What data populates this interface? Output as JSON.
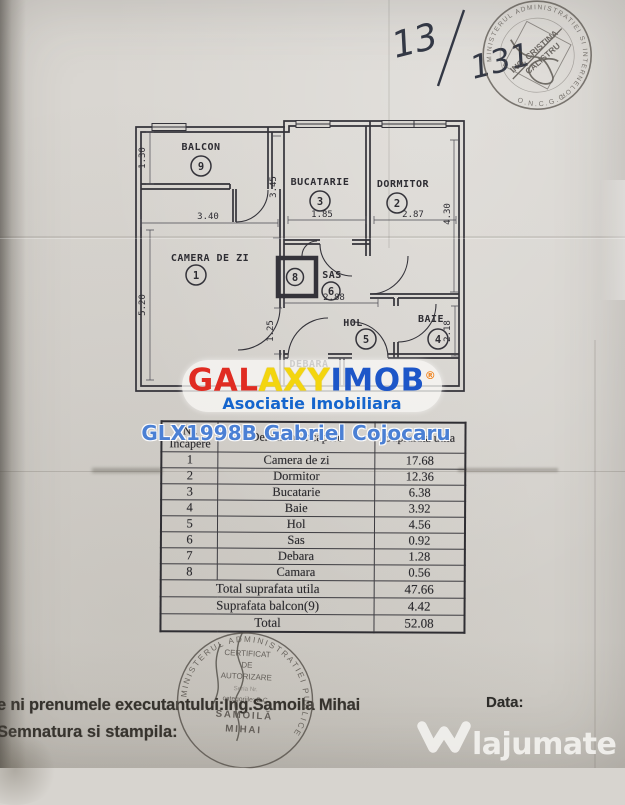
{
  "page": {
    "handwritten": {
      "part1": "13",
      "part2": "131"
    }
  },
  "top_stamp": {
    "ring_text": "MINISTERUL ADMINISTRATIEI SI INTERNELOR",
    "org_text": "O.N.C.G.C.",
    "name_line1": "ING. CRISTINA",
    "name_line2": "CALISTRU"
  },
  "floorplan": {
    "rooms": {
      "balcon": {
        "label": "BALCON",
        "num": "9"
      },
      "camera": {
        "label": "CAMERA DE ZI",
        "num": "1"
      },
      "bucatarie": {
        "label": "BUCATARIE",
        "num": "3"
      },
      "dormitor": {
        "label": "DORMITOR",
        "num": "2"
      },
      "sas": {
        "label": "SAS",
        "num": "6"
      },
      "hol": {
        "label": "HOL",
        "num": "5"
      },
      "baie": {
        "label": "BAIE",
        "num": "4"
      },
      "debara": {
        "label": "DEBARA",
        "num": "7"
      },
      "camara": {
        "num": "8"
      }
    },
    "dims": {
      "balcon_h": "1.30",
      "camera_w": "3.40",
      "camera_h": "5.20",
      "bucatarie_h": "3.45",
      "bucatarie_w": "1.85",
      "dormitor_w": "2.87",
      "dormitor_h": "4.30",
      "sas_w": "2.88",
      "hol_h": "1.25",
      "baie_h": "2.18"
    }
  },
  "logo": {
    "part1": "GAL",
    "part2": "AXY",
    "part3": "IMOB",
    "reg": "®",
    "subtitle": "Asociatie Imobiliara"
  },
  "watermark": {
    "agent": "GLX1998B Gabriel Cojocaru"
  },
  "table": {
    "header": {
      "col1a": "Nr.",
      "col1b": "Incapere",
      "col2": "Denumire incapere",
      "col3": "Suprafata utila"
    },
    "rows": [
      {
        "nr": "1",
        "name": "Camera de zi",
        "area": "17.68"
      },
      {
        "nr": "2",
        "name": "Dormitor",
        "area": "12.36"
      },
      {
        "nr": "3",
        "name": "Bucatarie",
        "area": "6.38"
      },
      {
        "nr": "4",
        "name": "Baie",
        "area": "3.92"
      },
      {
        "nr": "5",
        "name": "Hol",
        "area": "4.56"
      },
      {
        "nr": "6",
        "name": "Sas",
        "area": "0.92"
      },
      {
        "nr": "7",
        "name": "Debara",
        "area": "1.28"
      },
      {
        "nr": "8",
        "name": "Camara",
        "area": "0.56"
      }
    ],
    "footer": [
      {
        "label": "Total suprafata utila",
        "area": "47.66"
      },
      {
        "label": "Suprafata balcon(9)",
        "area": "4.42"
      },
      {
        "label": "Total",
        "area": "52.08"
      }
    ]
  },
  "bottom": {
    "line1": "e ni prenumele executantului:Ing.Samoila Mihai",
    "line2": "Semnatura si stampila:",
    "date_label": "Data:"
  },
  "bottom_stamp": {
    "ring_text": "MINISTERUL ADMINISTRATIEI PUBLICE",
    "line1": "CERTIFICAT",
    "line2": "DE",
    "line3": "AUTORIZARE",
    "line4": "Seria    Nr.",
    "line5": "categoriile: B.C",
    "line6": "SAMOILĂ",
    "line7": "MIHAI"
  },
  "site": {
    "name": "lajumate",
    "tld": ".ro"
  },
  "colors": {
    "logo_red": "#e02c22",
    "logo_yellow": "#f3d50e",
    "logo_blue": "#1d56c8",
    "logo_orange": "#f08018",
    "watermark_blue": "#4b80d4",
    "site_cyan": "#9ddfe9",
    "paper": "#d7d4cf",
    "ink": "#2e2d33"
  }
}
